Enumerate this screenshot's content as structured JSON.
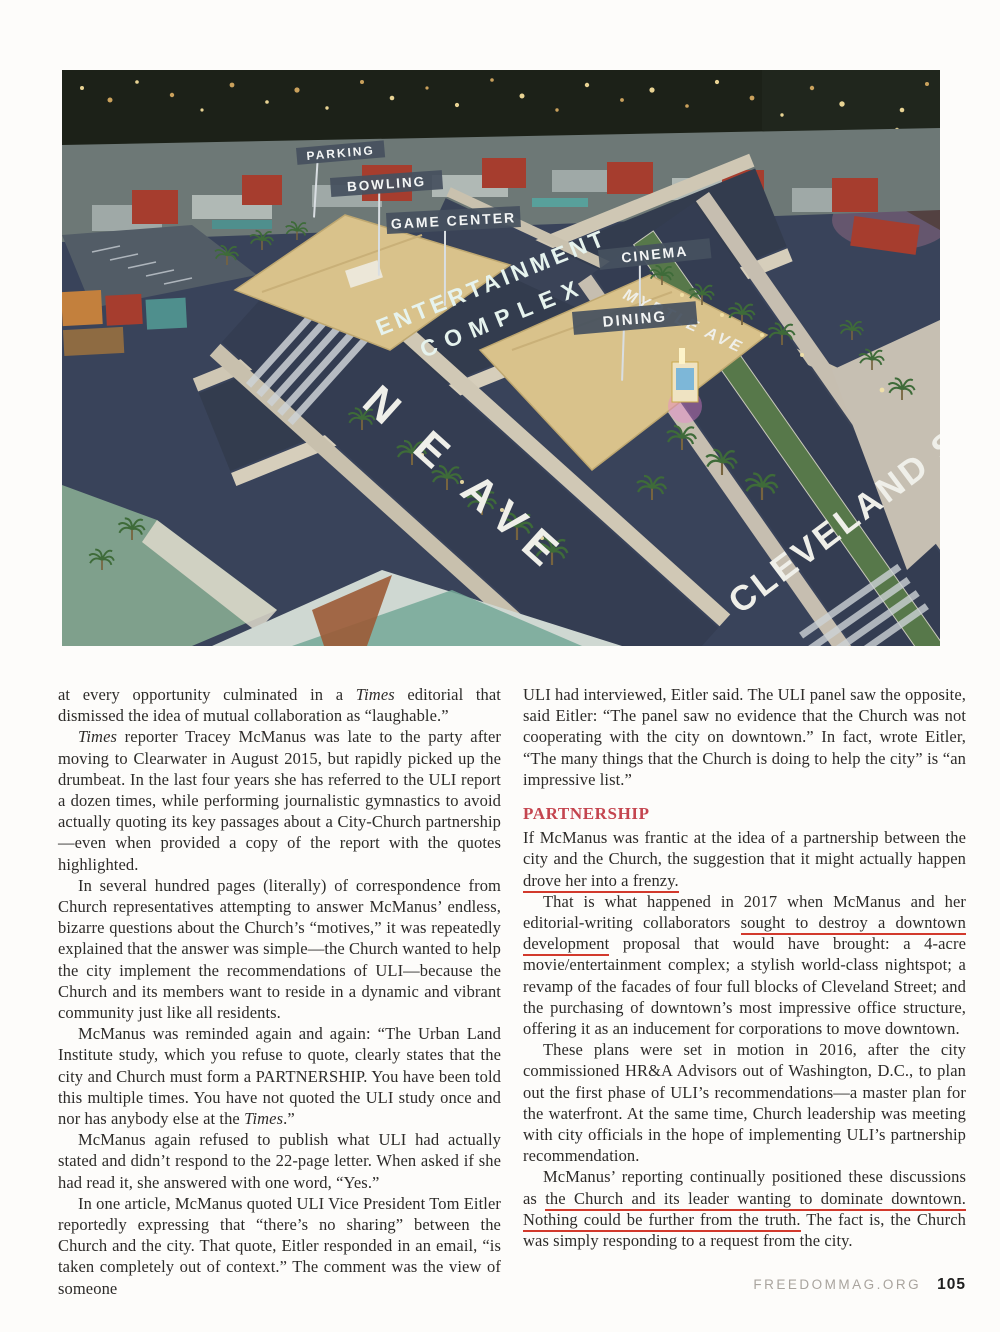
{
  "photo": {
    "signs": {
      "parking": "PARKING",
      "bowling": "BOWLING",
      "game_center": "GAME CENTER",
      "cinema": "CINEMA",
      "dining": "DINING"
    },
    "streets": {
      "myrtle": "MYRTLE AVE",
      "ne_ave": "N E AVE",
      "cleveland": "CLEVELAND ST"
    },
    "complex_line1": "ENTERTAINMENT",
    "complex_line2": "COMPLEX"
  },
  "colors": {
    "heading_red": "#c4454f",
    "underline_red": "#d2392c",
    "sign_slate": "#46515f",
    "roof_tan": "#d9c28b",
    "street_navy": "#39435a",
    "median_grass": "#57784a"
  },
  "article": {
    "left": {
      "p1": {
        "a": "at every opportunity culminated in a ",
        "times": "Times",
        "b": " editorial that dismissed the idea of mutual collaboration as “laughable.”"
      },
      "p2": {
        "times": "Times",
        "a": " reporter Tracey McManus was late to the party after moving to Clearwater in August 2015, but rapidly picked up the drumbeat. In the last four years she has referred to the ULI report a dozen times, while performing journalistic gymnastics to avoid actually quoting its key passages about a City-Church partnership—even when provided a copy of the report with the quotes highlighted."
      },
      "p3": "In several hundred pages (literally) of correspondence from Church representatives attempting to answer McManus’ endless, bizarre questions about the Church’s “motives,” it was repeatedly explained that the answer was simple—the Church wanted to help the city implement the recommendations of ULI—because the Church and its members want to reside in a dynamic and vibrant community just like all residents.",
      "p4": {
        "a": "McManus was reminded again and again: “The Urban Land Institute study, which you refuse to quote, clearly states that the city and Church must form a PARTNERSHIP. You have been told this multiple times. You have not quoted the ULI study once and nor has anybody else at the ",
        "times": "Times",
        "b": ".”"
      },
      "p5": "McManus again refused to publish what ULI had actually stated and didn’t respond to the 22-page letter. When asked if she had read it, she answered with one word, “Yes.”",
      "p6": "In one article, McManus quoted ULI Vice President Tom Eitler reportedly expressing that “there’s no sharing” between the Church and the city. That quote, Eitler responded in an email, “is taken completely out of context.” The comment was the view of someone"
    },
    "right": {
      "p1": "ULI had interviewed, Eitler said. The ULI panel saw the opposite, said Eitler: “The panel saw no evidence that the Church was not cooperating with the city on downtown.” In fact, wrote Eitler, “The many things that the Church is doing to help the city” is “an impressive list.”",
      "heading": "PARTNERSHIP",
      "p2": {
        "a": "If McManus was frantic at the idea of a partnership between the city and the Church, the suggestion that it might actually happen ",
        "u": "drove her into a frenzy."
      },
      "p3": {
        "a": "That is what happened in 2017 when McManus and her editorial-writing collaborators ",
        "u": "sought to destroy a downtown development",
        "b": " proposal that would have brought: a 4-acre movie/entertainment complex; a stylish world-class nightspot; a revamp of the facades of four full blocks of Cleveland Street; and the purchasing of downtown’s most impressive office structure, offering it as an inducement for corporations to move downtown."
      },
      "p4": "These plans were set in motion in 2016, after the city commissioned HR&A Advisors out of Washington, D.C., to plan out the first phase of ULI’s recommendations—a master plan for the waterfront. At the same time, Church leadership was meeting with city officials in the hope of implementing ULI’s partnership recommendation.",
      "p5": {
        "a": "McManus’ reporting continually positioned these discussions as ",
        "u": "the Church and its leader wanting to dominate downtown. Nothing could be further from the truth.",
        "b": " The fact is, the Church was simply responding to a request from the city."
      }
    }
  },
  "footer": {
    "site": "FREEDOMMAG.ORG",
    "page_number": "105"
  }
}
